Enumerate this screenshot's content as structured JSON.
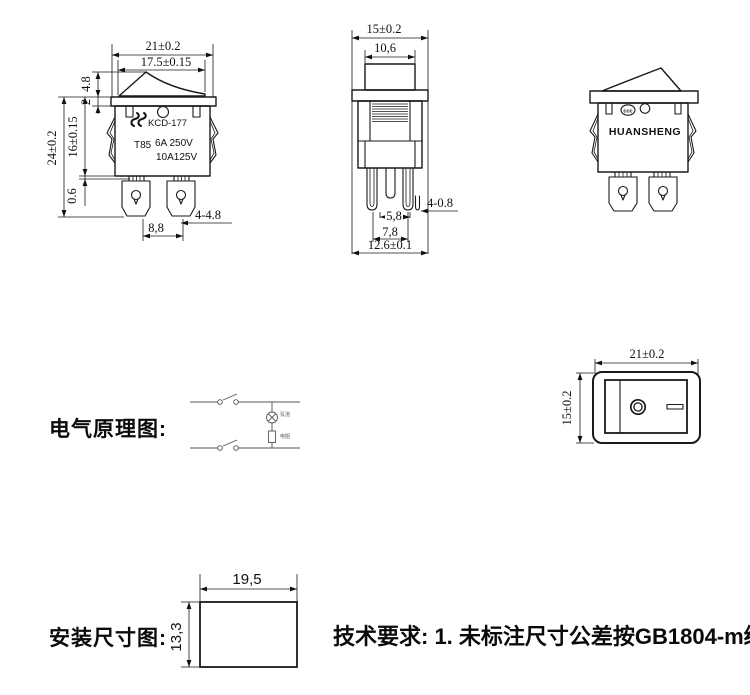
{
  "front_view": {
    "dim_width": "21±0.2",
    "dim_rocker_width": "17.5±0.15",
    "dim_rocker_height": "4.8",
    "dim_flange": "2",
    "dim_total_height": "24±0.2",
    "dim_body_height": "16±0.15",
    "dim_gap": "0.6",
    "dim_pin_pitch": "8,8",
    "dim_pin_note": "4-4.8",
    "model": "KCD-177",
    "rating_code": "T85",
    "rating_line1": "6A 250V",
    "rating_line2": "10A125V"
  },
  "side_view": {
    "dim_width": "15±0.2",
    "dim_rocker": "10,6",
    "dim_pins_inner": "5,8",
    "dim_pins_outer": "7,8",
    "dim_total": "12.6±0.1",
    "dim_pin_note": "4-0.8"
  },
  "iso_view": {
    "brand": "HUANSHENG",
    "cert_mark": "ccc"
  },
  "schematic": {
    "label": "电气原理图:",
    "lamp_label": "氖泡",
    "resistor_label": "电阻"
  },
  "panel_view": {
    "dim_width": "21±0.2",
    "dim_height": "15±0.2"
  },
  "install_view": {
    "label": "安装尺寸图:",
    "dim_width": "19,5",
    "dim_height": "13,3"
  },
  "notes": {
    "tech_requirements": "技术要求: 1. 未标注尺寸公差按GB1804-m级"
  },
  "colors": {
    "line": "#1a1a1a",
    "brand": "#3a120c",
    "schematic": "#555555"
  }
}
